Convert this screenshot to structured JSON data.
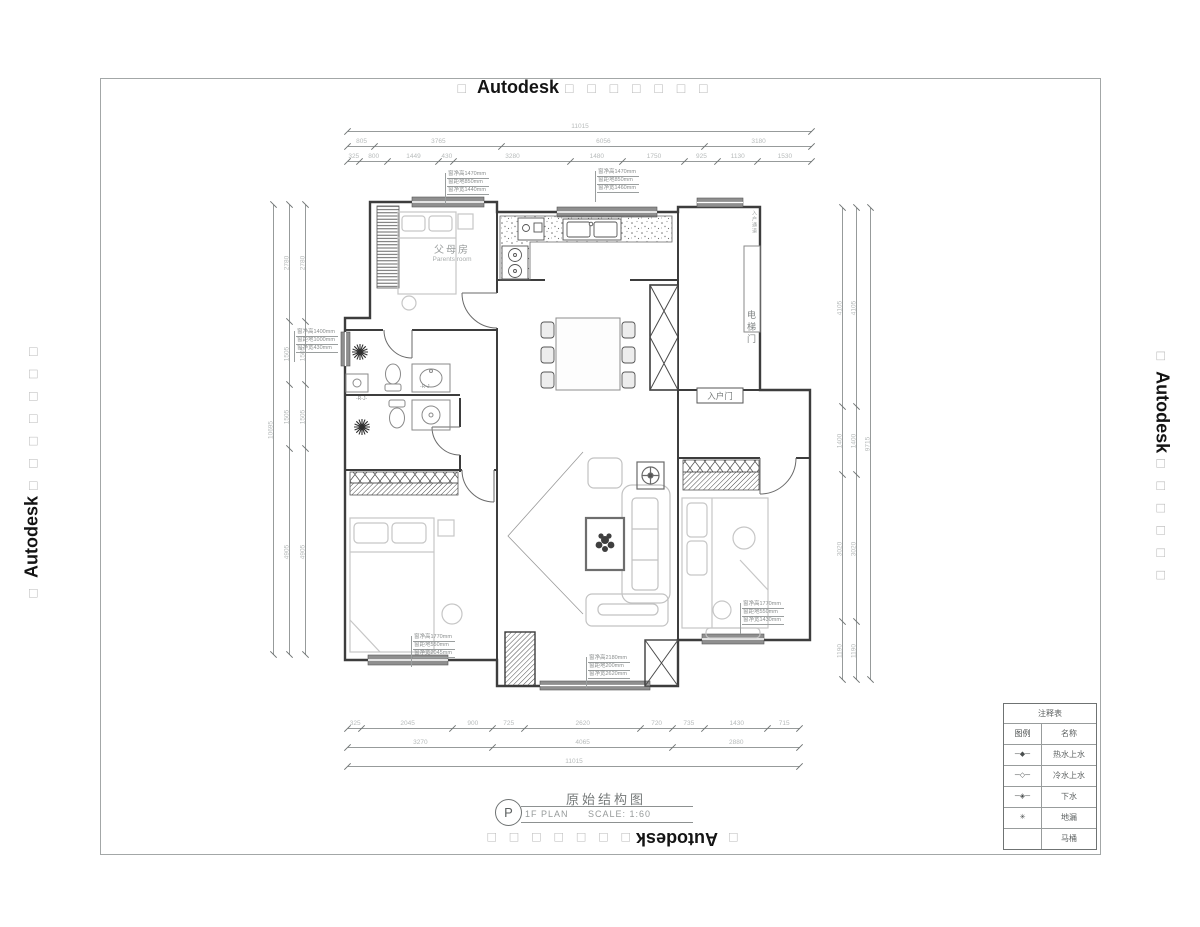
{
  "watermarks": {
    "top": {
      "prefix": "□",
      "brand": "Autodesk",
      "suffix": "□ □ □ □ □ □ □"
    },
    "bottom": {
      "prefix": "□",
      "brand": "Autodesk",
      "suffix": "□ □ □ □ □ □ □"
    },
    "left": {
      "prefix": "□",
      "brand": "Autodesk",
      "suffix": "□ □ □ □ □ □ □"
    },
    "right": {
      "prefix": "□",
      "brand": "Autodesk",
      "suffix": "□ □ □ □ □ □"
    }
  },
  "plan": {
    "rooms": {
      "parents_cn": "父母房",
      "parents_en": "Parents room",
      "elevator_door": "电梯门",
      "entry_door": "入户门",
      "shaft_note": "入户通道"
    },
    "fixtures": {
      "rj1": "-R-J-",
      "rj2": "-R-J-"
    },
    "window_notes": [
      [
        "窗净高1470mm",
        "窗距地850mm",
        "窗净宽1440mm"
      ],
      [
        "窗净高1470mm",
        "窗距地850mm",
        "窗净宽1460mm"
      ],
      [
        "窗净高1400mm",
        "窗距地1000mm",
        "窗净宽430mm"
      ],
      [
        "窗净高1770mm",
        "窗距地550mm",
        "窗净宽2045mm"
      ],
      [
        "窗净高2180mm",
        "窗距地200mm",
        "窗净宽2620mm"
      ],
      [
        "窗净高1770mm",
        "窗距地550mm",
        "窗净宽1430mm"
      ]
    ]
  },
  "dimensions": {
    "top": {
      "row1": [
        "11015"
      ],
      "row2": [
        "805",
        "3765",
        "6056",
        "3180"
      ],
      "row3": [
        "325",
        "800",
        "1449",
        "430",
        "3280",
        "1480",
        "1750",
        "925",
        "1130",
        "1530"
      ]
    },
    "bottom": {
      "row1": [
        "325",
        "2045",
        "900",
        "725",
        "2620",
        "720",
        "735",
        "1430",
        "715"
      ],
      "row2": [
        "3270",
        "4065",
        "2880"
      ],
      "row3": [
        "11015"
      ]
    },
    "left": {
      "total": [
        "10695"
      ],
      "chain": [
        "2780",
        "1505",
        "1505",
        "4905"
      ]
    },
    "right": {
      "total": [
        "9715"
      ],
      "chain": [
        "4105",
        "1400",
        "3020",
        "1190"
      ]
    }
  },
  "title_block": {
    "bubble": "P",
    "plan": "1F PLAN",
    "title": "原始结构图",
    "scale": "SCALE:  1:60"
  },
  "legend": {
    "title": "注释表",
    "col_symbol": "图例",
    "col_name": "名称",
    "rows": [
      {
        "symbol": "─◆─",
        "name": "热水上水"
      },
      {
        "symbol": "─◇─",
        "name": "冷水上水"
      },
      {
        "symbol": "─◈─",
        "name": "下水"
      },
      {
        "symbol": "✳",
        "name": "地漏"
      },
      {
        "symbol": "",
        "name": "马桶"
      }
    ]
  }
}
